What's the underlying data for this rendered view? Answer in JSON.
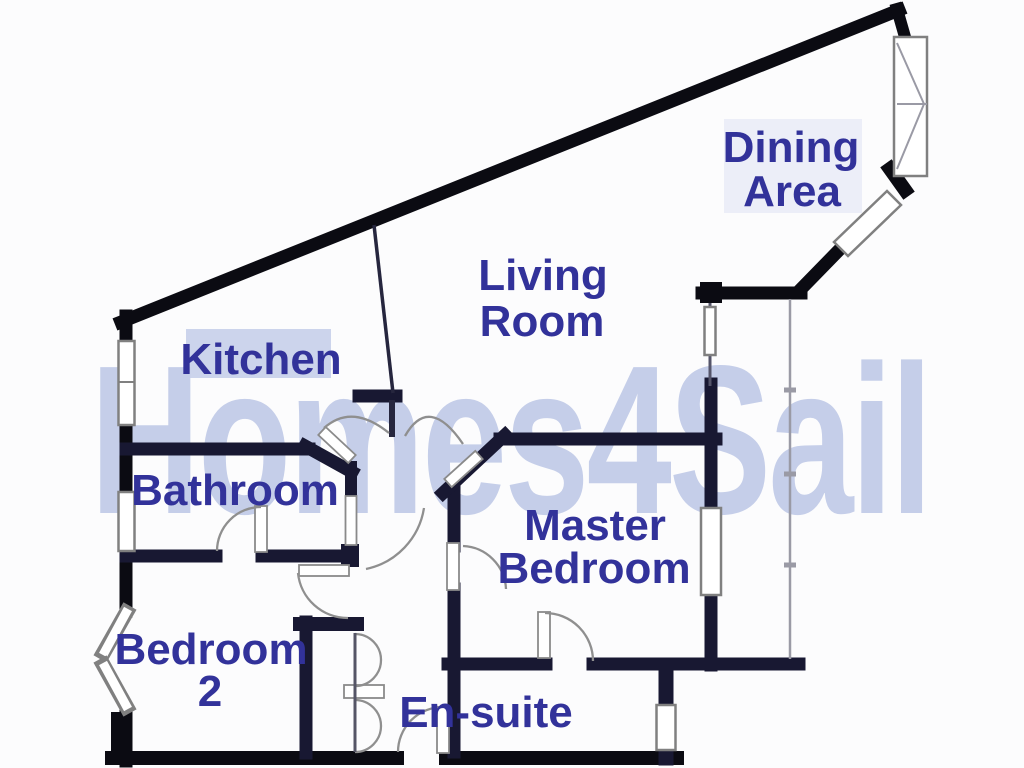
{
  "meta": {
    "type": "estate-agent floor plan",
    "background_color": "#fcfcfd",
    "wall_color": "#0b0b12",
    "label_color": "#32329a"
  },
  "watermark": {
    "text": "Homes4Sail",
    "color": "#c5cee9"
  },
  "rooms": {
    "kitchen": {
      "name": "Kitchen",
      "lines": [
        "Kitchen"
      ]
    },
    "living_room": {
      "name": "Living Room",
      "lines": [
        "Living",
        "Room"
      ]
    },
    "dining_area": {
      "name": "Dining Area",
      "lines": [
        "Dining",
        "Area"
      ]
    },
    "bathroom": {
      "name": "Bathroom",
      "lines": [
        "Bathroom"
      ]
    },
    "master_bedroom": {
      "name": "Master Bedroom",
      "lines": [
        "Master",
        "Bedroom"
      ]
    },
    "bedroom_2": {
      "name": "Bedroom 2",
      "lines": [
        "Bedroom",
        "2"
      ]
    },
    "en_suite": {
      "name": "En-suite",
      "lines": [
        "En-suite"
      ]
    }
  },
  "features": {
    "windows": [
      "kitchen-left-window",
      "bathroom-left-window",
      "bedroom2-bay-window",
      "dining-corner-window",
      "dining-angled-window",
      "master-bedroom-window",
      "en-suite-window",
      "balcony-small-window"
    ],
    "doors": [
      "entrance-door",
      "kitchen-door",
      "living-room-door",
      "bathroom-hall-door",
      "bathroom-bedroom2-door",
      "bedroom2-door",
      "master-bedroom-door",
      "en-suite-door",
      "hall-closet-bifold-doors"
    ]
  }
}
